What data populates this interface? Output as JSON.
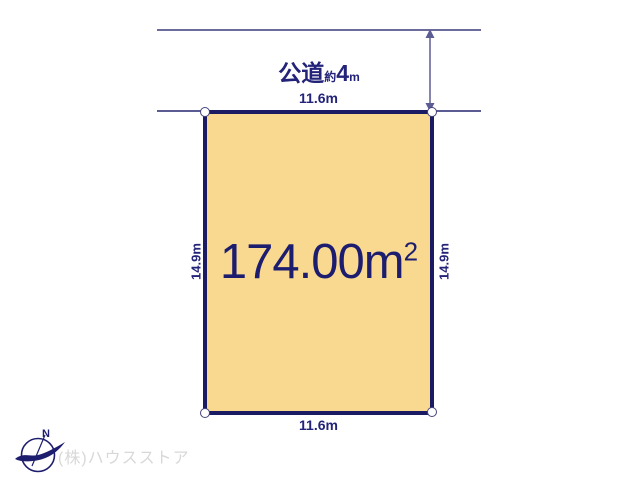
{
  "road": {
    "label_name": "公道",
    "label_approx": "約",
    "label_value": "4",
    "label_unit": "m"
  },
  "dimensions": {
    "top_width": "11.6m",
    "bottom_width": "11.6m",
    "left_depth": "14.9m",
    "right_depth": "14.9m"
  },
  "plot": {
    "area_main": "174.00m",
    "area_exponent": "2"
  },
  "compass": {
    "north_label": "N"
  },
  "footer": {
    "company_name": "(株)ハウスストア"
  },
  "colors": {
    "plot_fill": "#f8d98f",
    "plot_border": "#1b1b63",
    "dimension_line": "#6b6b9c",
    "label_text": "#23237a",
    "company_text": "#d8d8d8"
  }
}
